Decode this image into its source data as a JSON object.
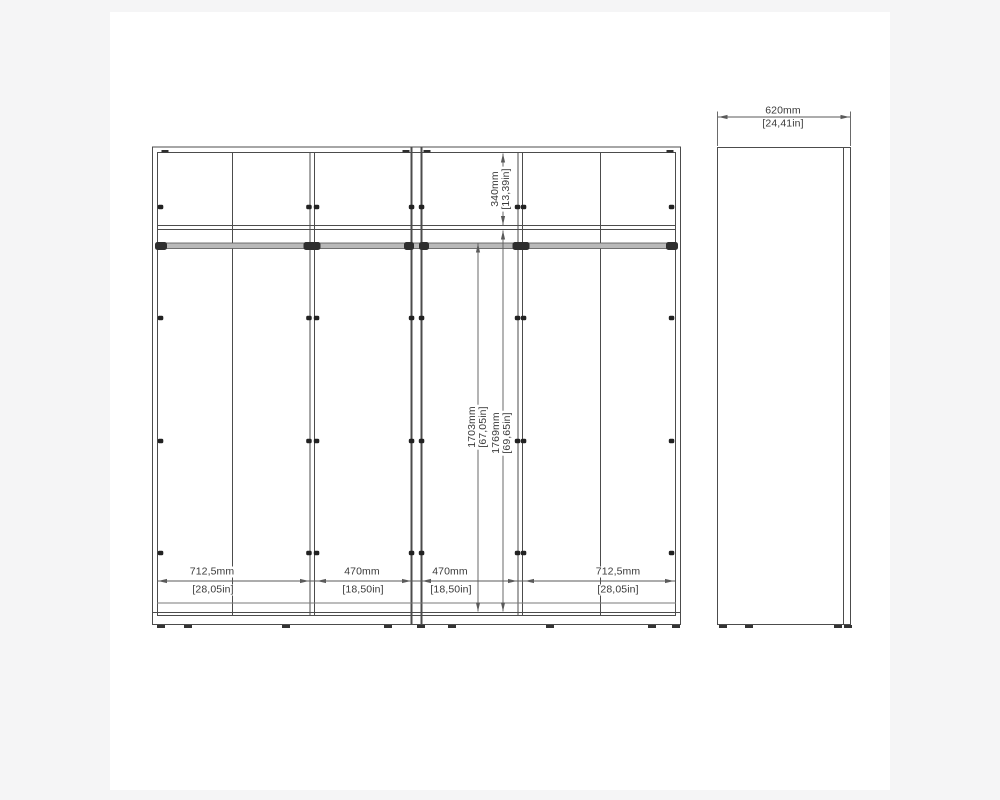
{
  "drawing": {
    "title": "wardrobe-technical-drawing",
    "views": [
      "front-elevation",
      "side-elevation"
    ]
  },
  "front_view": {
    "bottom_width_dims": [
      {
        "mm": "712,5mm",
        "in": "[28,05in]"
      },
      {
        "mm": "470mm",
        "in": "[18,50in]"
      },
      {
        "mm": "470mm",
        "in": "[18,50in]"
      },
      {
        "mm": "712,5mm",
        "in": "[28,05in]"
      }
    ],
    "top_section_dim": {
      "mm": "340mm",
      "in": "[13,39in]"
    },
    "interior_height_dim": {
      "mm": "1703mm",
      "in": "[67,05in]"
    },
    "door_height_dim": {
      "mm": "1769mm",
      "in": "[69,65in]"
    }
  },
  "side_view": {
    "depth_dim": {
      "mm": "620mm",
      "in": "[24,41in]"
    }
  },
  "colors": {
    "page_bg": "#f5f5f6",
    "canvas": "#ffffff",
    "line": "#4c4c4c",
    "dim_line": "#5a5a5a",
    "text": "#3a3a3a",
    "rail_fill": "#b9b9b9",
    "cap_fill": "#2e2e2e"
  }
}
